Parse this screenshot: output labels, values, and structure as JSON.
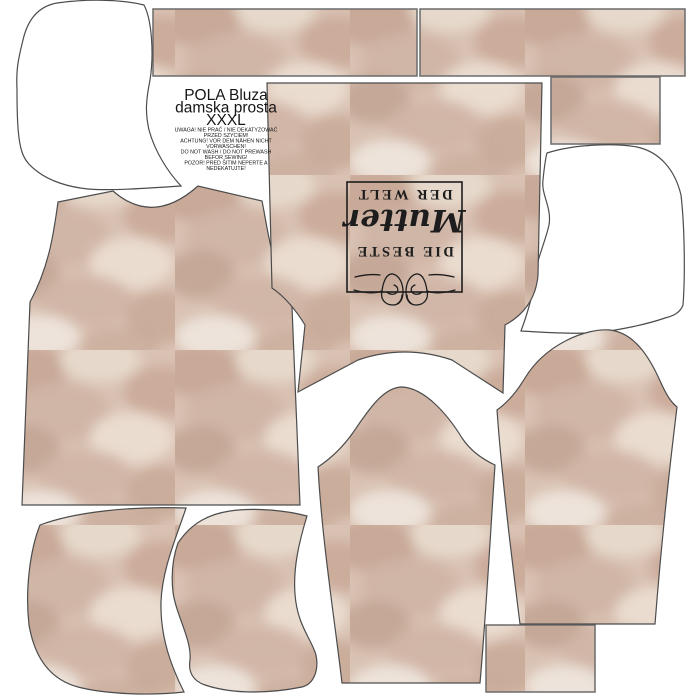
{
  "panel": {
    "product_title": {
      "line1": "POLA Bluza",
      "line2": "damska prosta",
      "line3": "XXXL"
    },
    "care_warnings": {
      "l1": "UWAGA! NIE PRAĆ / NIE DEKATYZOWAĆ",
      "l2": "PRZED SZYCIEM!",
      "l3": "ACHTUNG! VOR DEM NÄHEN NICHT",
      "l4": "VORWASCHEN!",
      "l5": "DO NOT WASH / DO NOT PREWASH",
      "l6": "BEFOR SEWING!",
      "l7": "POZOR! PRED ŠITIM NEPERTE A",
      "l8": "NEDEKATUJTE!"
    },
    "label": {
      "top": "DIE BESTE",
      "script": "Mutter",
      "bottom": "DER WELT",
      "rotation_deg": "180"
    },
    "colors": {
      "background": "#ffffff",
      "fabric_base": "#d9c2b3",
      "fabric_dark": "#c5a493",
      "fabric_light": "#ecdfd3",
      "outline": "#4c4c4c",
      "label_ink": "#1d1d1d"
    },
    "pieces": {
      "fabric_pieces": [
        "top-strip-left",
        "top-strip-right",
        "small-rect-top-right",
        "back-bodice",
        "front-bodice",
        "center-sleeve",
        "right-sleeve",
        "hood-fabric-bottom-left",
        "hood-fabric-bottom-center",
        "small-rect-bottom-right"
      ],
      "white_pieces": [
        "hood-outline-top-left",
        "hood-outline-right"
      ]
    }
  }
}
